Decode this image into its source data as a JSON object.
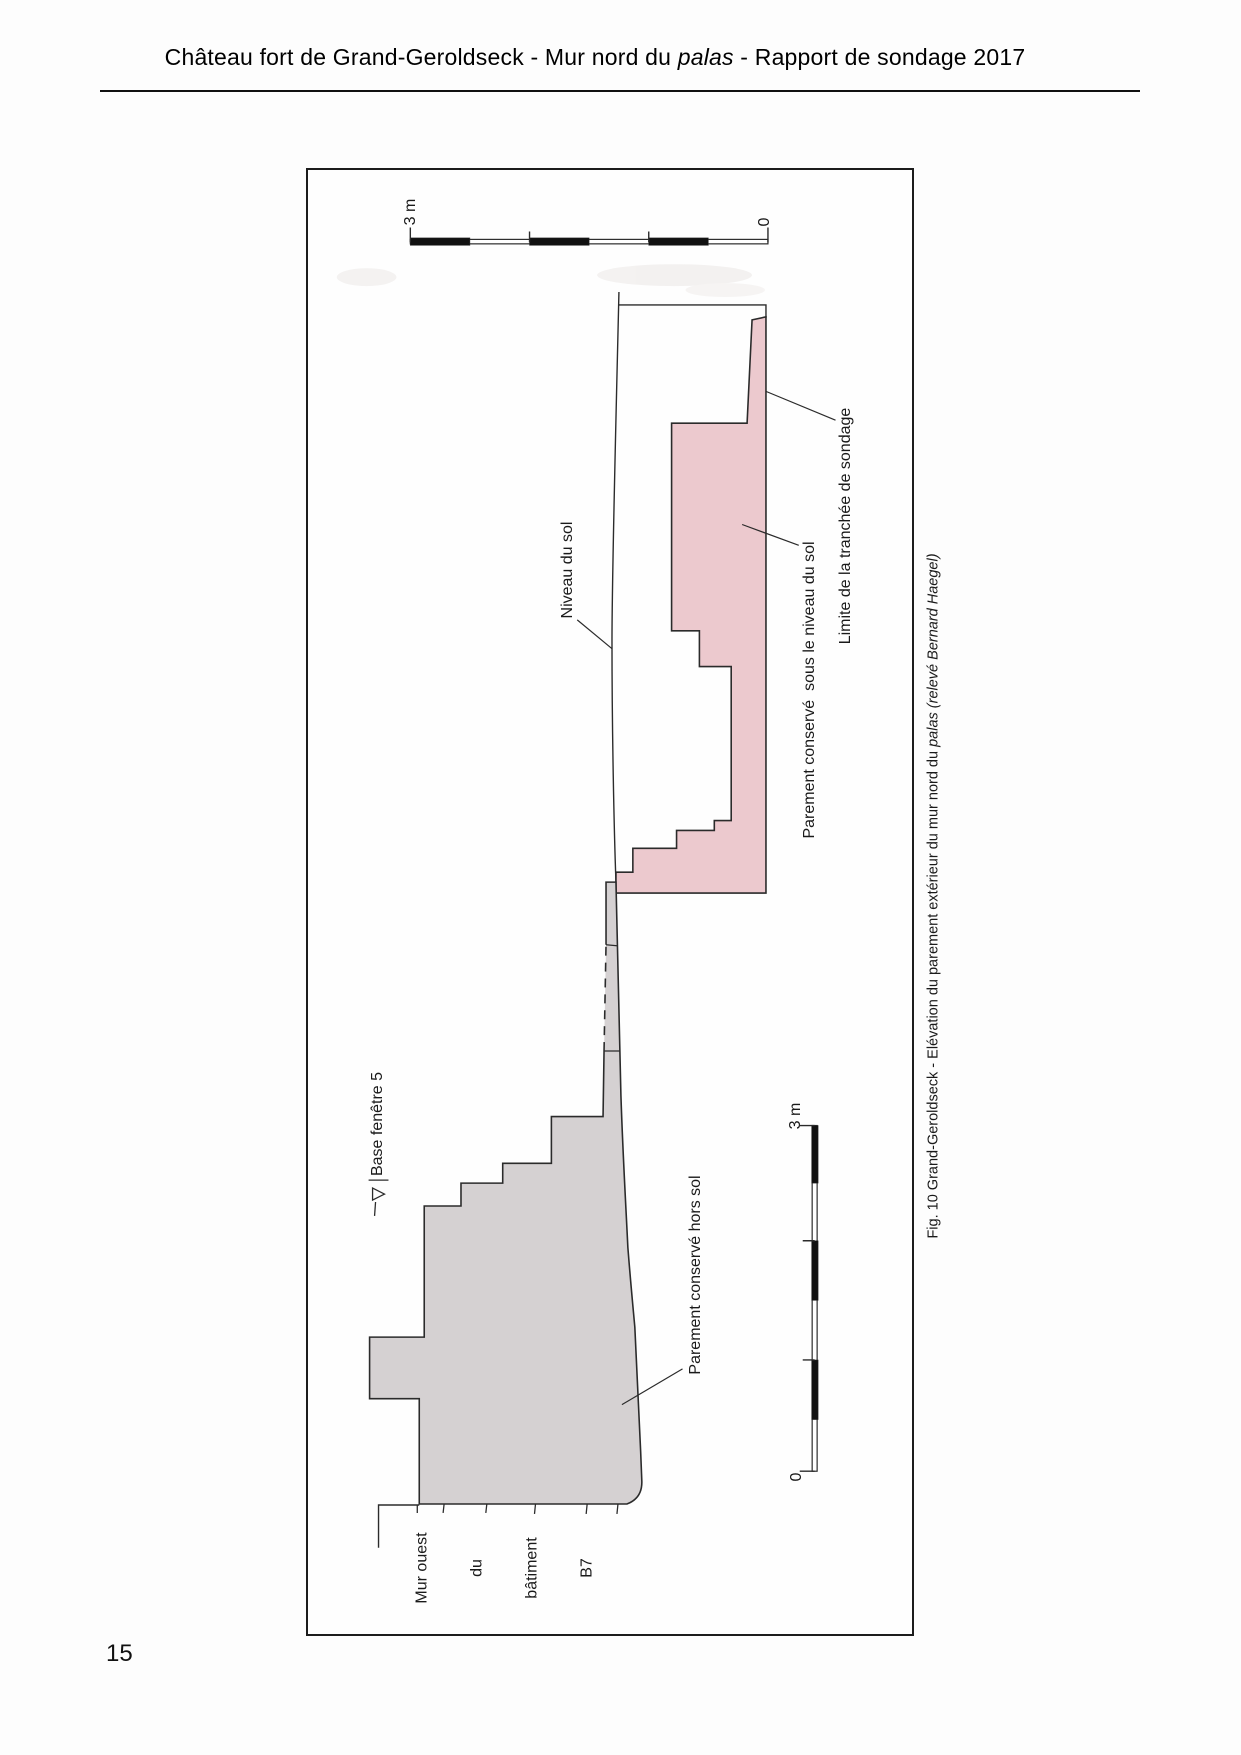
{
  "header": {
    "title_prefix": "Château fort de Grand-Geroldseck - Mur nord du ",
    "title_italic": "palas",
    "title_suffix": " - Rapport de sondage 2017"
  },
  "page_number": "15",
  "figure": {
    "scale_bar_top": {
      "max_label": "3 m",
      "zero_label": "0"
    },
    "scale_bar_bottom": {
      "max_label": "3 m",
      "zero_label": "0"
    },
    "labels": {
      "niveau_du_sol": "Niveau du sol",
      "parement_sous_sol": "Parement conservé  sous le niveau du sol",
      "limite_tranchee": "Limite de la tranchée de sondage",
      "base_fenetre": "Base fenêtre 5",
      "parement_hors_sol": "Parement conservé hors sol",
      "mur_ouest_lines": [
        "Mur ouest",
        "du",
        "bâtiment",
        "B7"
      ]
    },
    "caption": {
      "prefix": "Fig. 10 Grand-Geroldseck - Elévation du parement extérieur du mur nord du ",
      "italic_word": "palas",
      "separator": " ",
      "credit_italic": "(relevé Bernard Haegel)"
    },
    "colors": {
      "facing_below_ground": "#ecc9ce",
      "facing_above_ground": "#d5d1d2",
      "line": "#2b2b2b"
    }
  }
}
